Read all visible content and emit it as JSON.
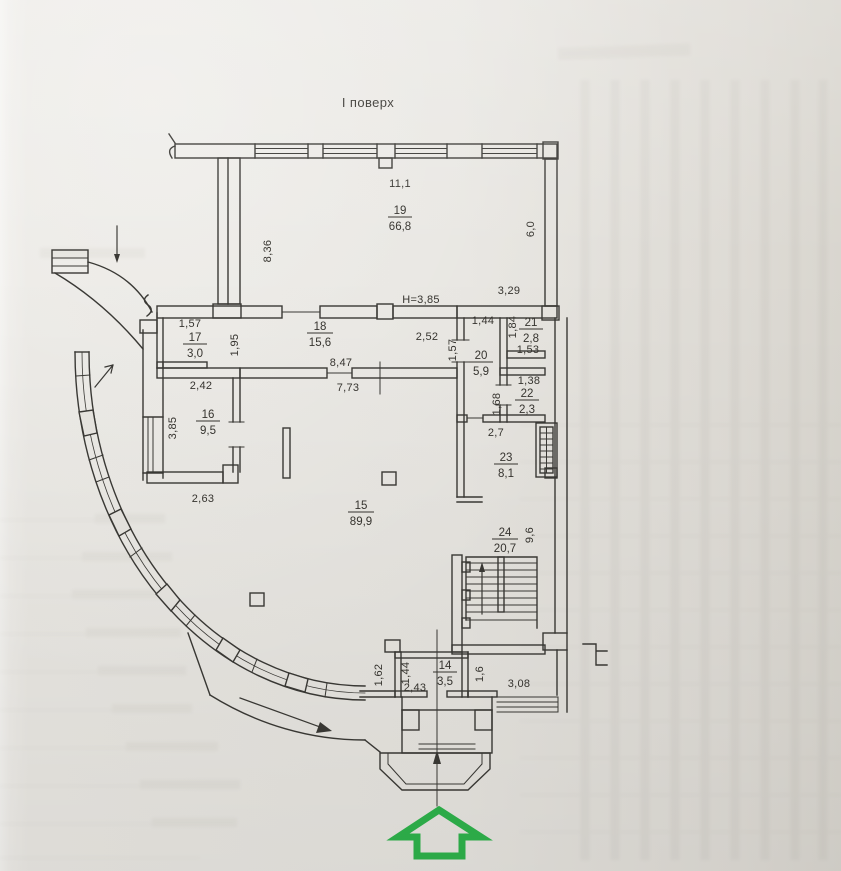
{
  "title": "І поверх",
  "height_note": "H=3,85",
  "colors": {
    "paper": "#e7e5e0",
    "line": "#3a3935",
    "arrow_green": "#2eb24b"
  },
  "rooms": [
    {
      "num": "19",
      "area": "66,8"
    },
    {
      "num": "17",
      "area": "3,0"
    },
    {
      "num": "18",
      "area": "15,6"
    },
    {
      "num": "21",
      "area": "2,8"
    },
    {
      "num": "20",
      "area": "5,9"
    },
    {
      "num": "22",
      "area": "2,3"
    },
    {
      "num": "16",
      "area": "9,5"
    },
    {
      "num": "23",
      "area": "8,1"
    },
    {
      "num": "15",
      "area": "89,9"
    },
    {
      "num": "24",
      "area": "20,7"
    },
    {
      "num": "14",
      "area": "3,5"
    }
  ],
  "dims": [
    {
      "text": "11,1"
    },
    {
      "text": "6,0"
    },
    {
      "text": "8,36"
    },
    {
      "text": "3,29"
    },
    {
      "text": "1,57"
    },
    {
      "text": "1,95"
    },
    {
      "text": "2,52"
    },
    {
      "text": "1,44"
    },
    {
      "text": "1,84"
    },
    {
      "text": "1,53"
    },
    {
      "text": "8,47"
    },
    {
      "text": "1,57"
    },
    {
      "text": "7,73"
    },
    {
      "text": "2,42"
    },
    {
      "text": "1,38"
    },
    {
      "text": "1,68"
    },
    {
      "text": "3,85"
    },
    {
      "text": "2,7"
    },
    {
      "text": "2,63"
    },
    {
      "text": "9,6"
    },
    {
      "text": "1,62"
    },
    {
      "text": "1,44"
    },
    {
      "text": "2,43"
    },
    {
      "text": "1,6"
    },
    {
      "text": "3,08"
    }
  ]
}
